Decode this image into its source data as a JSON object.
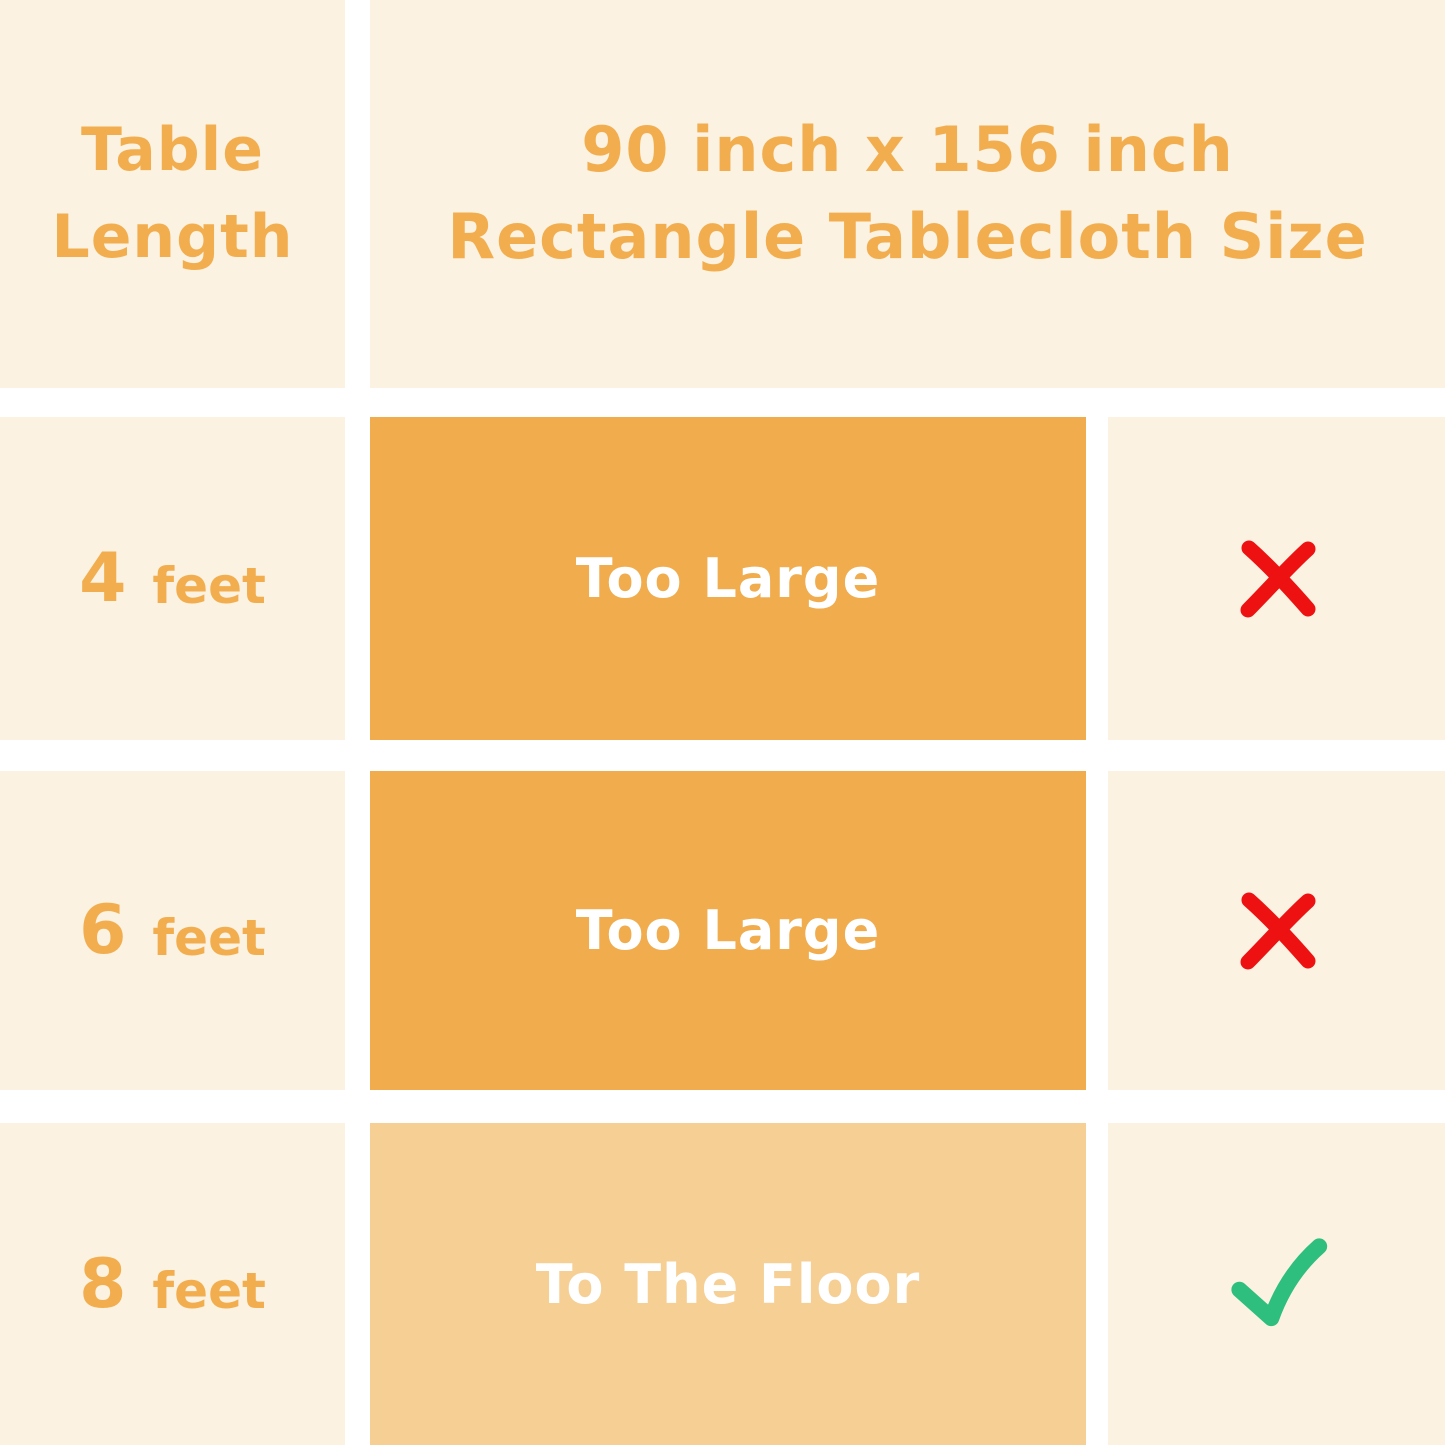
{
  "colors": {
    "background": "#FFFFFF",
    "cell_cream": "#FBF2E2",
    "accent_orange": "#F2AE4E",
    "bar_orange": "#F0AC4D",
    "bar_light_orange": "#F6CF95",
    "text_white": "#FFFFFF",
    "cross_red": "#EE1111",
    "check_green": "#2EBE7D"
  },
  "header": {
    "row_label_line1": "Table",
    "row_label_line2": "Length",
    "product_line1": "90 inch x 156 inch",
    "product_line2": "Rectangle Tablecloth Size"
  },
  "rows": [
    {
      "table_length_value": "4",
      "table_length_unit": "feet",
      "fit_text": "Too Large",
      "suitable": false,
      "verdict_icon": "cross-icon"
    },
    {
      "table_length_value": "6",
      "table_length_unit": "feet",
      "fit_text": "Too Large",
      "suitable": false,
      "verdict_icon": "cross-icon"
    },
    {
      "table_length_value": "8",
      "table_length_unit": "feet",
      "fit_text": "To The Floor",
      "suitable": true,
      "verdict_icon": "check-icon"
    }
  ],
  "chart_data": {
    "type": "table",
    "title": "90 inch x 156 inch Rectangle Tablecloth Size",
    "columns": [
      "Table Length",
      "90 inch x 156 inch Rectangle Tablecloth Size",
      "Suitable"
    ],
    "rows": [
      [
        "4 feet",
        "Too Large",
        "no"
      ],
      [
        "6 feet",
        "Too Large",
        "no"
      ],
      [
        "8 feet",
        "To The Floor",
        "yes"
      ]
    ]
  }
}
